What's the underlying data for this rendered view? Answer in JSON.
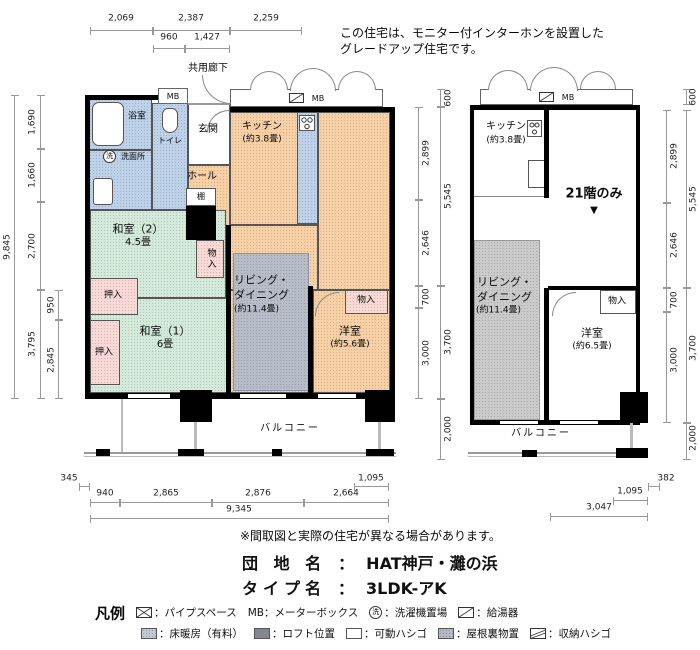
{
  "header": {
    "note_line1": "この住宅は、モニター付インターホンを設置した",
    "note_line2": "グレードアップ住宅です。",
    "corridor": "共用廊下"
  },
  "left_plan": {
    "mb_small": "MB",
    "mb_strip": "MB",
    "bath": "浴室",
    "toilet": "トイレ",
    "washroom": "洗面所",
    "wash_symbol": "洗",
    "entrance": "玄関",
    "kitchen": "キッチン",
    "kitchen_size": "(約3.8畳)",
    "hall": "ホール",
    "shelf": "棚",
    "washitsu2": "和室（2）",
    "washitsu2_size": "4.5畳",
    "washitsu1": "和室（1）",
    "washitsu1_size": "6畳",
    "living_line1": "リビング・",
    "living_line2": "ダイニング",
    "living_size": "(約11.4畳)",
    "western": "洋室",
    "western_size": "(約5.6畳)",
    "oshiire_upper": "押入",
    "oshiire_lower": "押入",
    "storage_upper": "物入",
    "storage_western": "物入",
    "balcony": "バルコニー"
  },
  "right_plan": {
    "mb_strip": "MB",
    "kitchen": "キッチン",
    "kitchen_size": "(約3.8畳)",
    "floor_note": "21階のみ",
    "floor_note_marker": "▼",
    "living_line1": "リビング・",
    "living_line2": "ダイニング",
    "living_size": "(約11.4畳)",
    "western": "洋室",
    "western_size": "(約6.5畳)",
    "storage": "物入",
    "balcony": "バルコニー"
  },
  "dimensions": {
    "top": {
      "d1": "2,069",
      "d2": "2,387",
      "d3": "2,259",
      "d4": "960",
      "d5": "1,427"
    },
    "left": {
      "total": "9,845",
      "s1": "1,690",
      "s2": "1,660",
      "s3": "2,700",
      "s4": "3,795",
      "sub1": "950",
      "sub2": "2,845"
    },
    "mid": {
      "mb_depth": "600",
      "s1": "2,899",
      "s2": "2,646",
      "s3": "700",
      "s4": "3,000",
      "o1": "5,545",
      "o2": "3,700",
      "balcony": "2,000"
    },
    "right": {
      "mb_depth": "600",
      "s1": "2,899",
      "s2": "2,646",
      "s3": "700",
      "s4": "3,000",
      "o1": "5,545",
      "o2": "3,700",
      "balcony": "2,000"
    },
    "bottom_left": {
      "offset": "345",
      "b1": "940",
      "b2": "2,865",
      "b3": "2,876",
      "b4": "2,664",
      "sub": "1,095",
      "total": "9,345"
    },
    "bottom_right": {
      "offset": "382",
      "sub": "1,095",
      "total": "3,047"
    }
  },
  "footer": {
    "disclaimer": "※間取図と実際の住宅が異なる場合があります。",
    "estate_label": "団 地 名",
    "estate_sep": "：",
    "estate_value": "HAT神戸・灘の浜",
    "type_label": "タイプ名",
    "type_sep": "：",
    "type_value": "3LDK-アK"
  },
  "legend": {
    "title": "凡例",
    "wash_symbol": "洗",
    "row1": [
      {
        "icon": "pipe-space",
        "label": "：パイプスペース"
      },
      {
        "icon": "text-mb",
        "label": "MB：メーターボックス"
      },
      {
        "icon": "washer-circle",
        "label": "：洗濯機置場"
      },
      {
        "icon": "water-heater",
        "label": "：給湯器"
      }
    ],
    "row2": [
      {
        "icon": "floor-heating-swatch",
        "label": "：床暖房（有料）"
      },
      {
        "icon": "loft-swatch",
        "label": "：ロフト位置"
      },
      {
        "icon": "movable-ladder-swatch",
        "label": "：可動ハシゴ"
      },
      {
        "icon": "attic-storage-swatch",
        "label": "：屋根裏物置"
      },
      {
        "icon": "storage-ladder",
        "label": "：収納ハシゴ"
      }
    ]
  },
  "colors": {
    "wall": "#000000",
    "water_rooms": "#bdd1e9",
    "tatami_rooms": "#d3eadb",
    "living_rooms": "#f8d0a6",
    "closets": "#f8d9d5",
    "floor_heating_left": "#b6bdc9",
    "floor_heating_right": "#cacaca",
    "dim_lines": "#999999"
  }
}
